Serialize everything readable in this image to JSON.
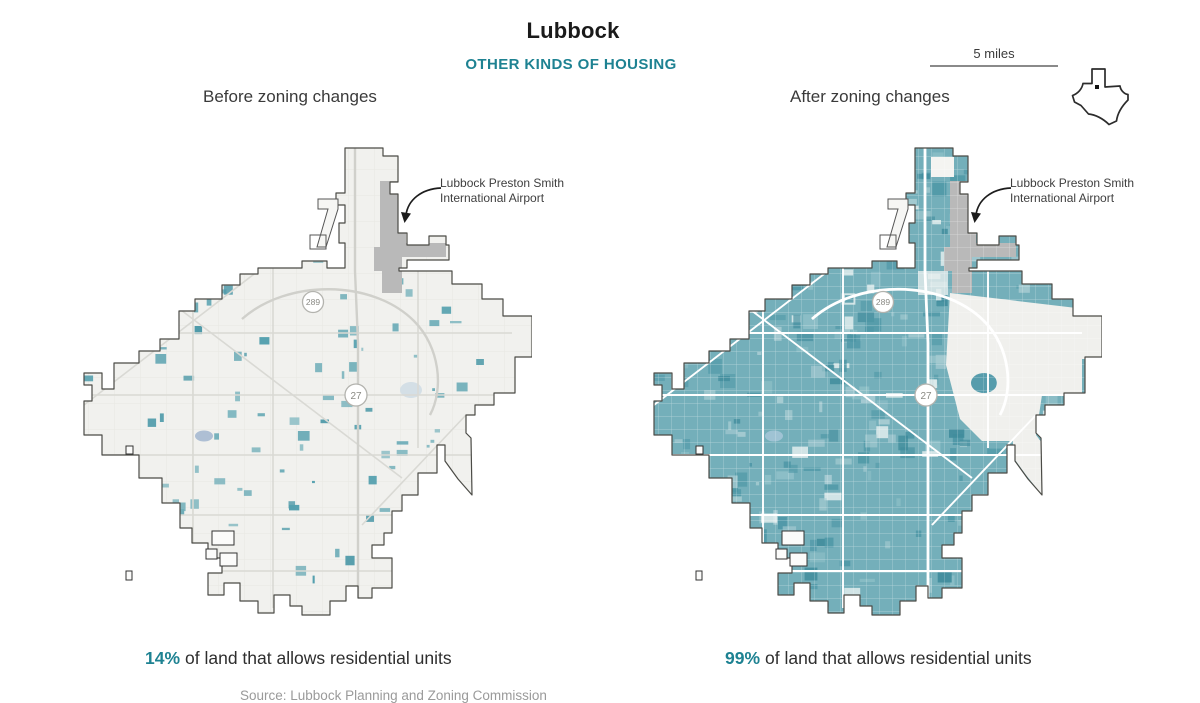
{
  "header": {
    "title": "Lubbock",
    "subtitle": "OTHER KINDS OF HOUSING"
  },
  "scale_bar": {
    "label": "5 miles"
  },
  "panels": [
    {
      "label": "Before zoning changes",
      "stat_value": "14%",
      "stat_text": "of land that allows residential units",
      "coverage_pct": 14
    },
    {
      "label": "After zoning changes",
      "stat_value": "99%",
      "stat_text": "of land that allows residential units",
      "coverage_pct": 99
    }
  ],
  "annotation": {
    "line1": "Lubbock Preston Smith",
    "line2": "International Airport"
  },
  "shields": [
    "289",
    "27"
  ],
  "source": "Source: Lubbock Planning and Zoning Commission",
  "colors": {
    "accent": "#1e8292",
    "map_bg": "#f1f1ee",
    "boundary": "#4b4b46",
    "airport": "#b9b9b9",
    "before_road": "#d9d9d4",
    "after_base": "#74afba",
    "after_dark": "#4e97a6",
    "after_light": "#a9cdd3",
    "after_road": "#ffffff",
    "before_parcels": [
      "#55a0ae",
      "#4d99a8",
      "#6fadb8",
      "#82b8c1"
    ]
  }
}
